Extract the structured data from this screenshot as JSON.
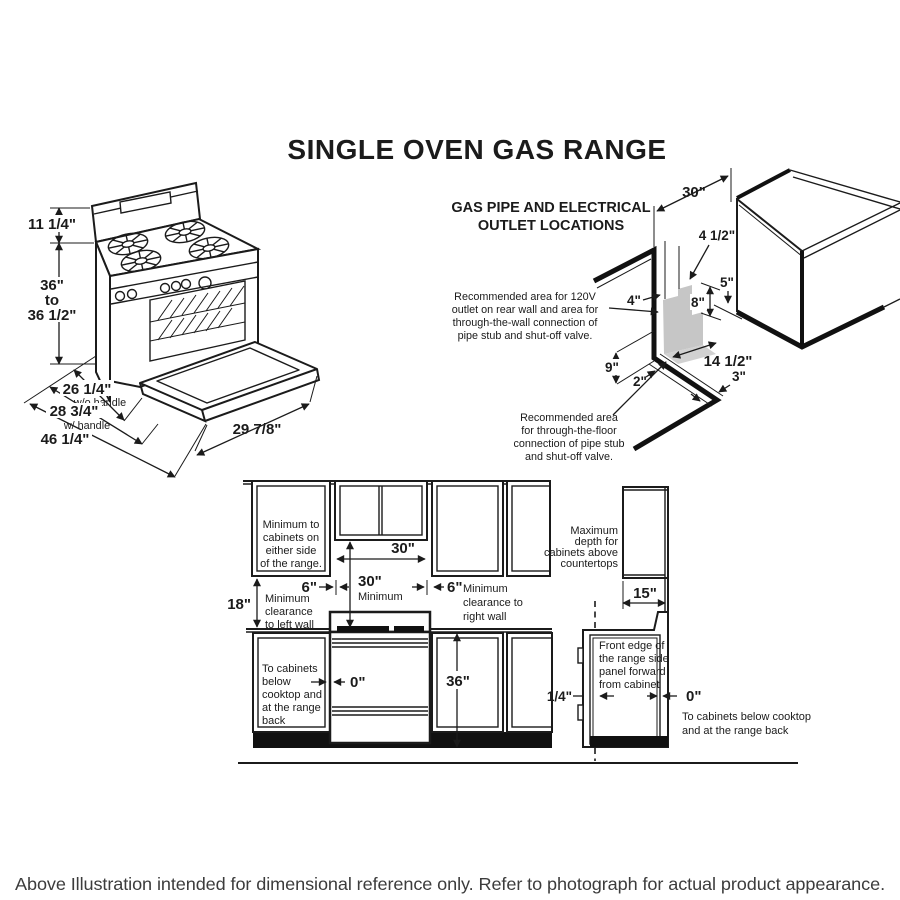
{
  "title": "SINGLE OVEN GAS RANGE",
  "footer": "Above Illustration intended for dimensional reference only. Refer to photograph for actual product appearance.",
  "accent_colors": {
    "line": "#1b1b1b",
    "shaded_area": "#c6c6c6"
  },
  "range_isometric": {
    "backsplash_height": "11 1/4\"",
    "height_min": "36\"",
    "height_to": "to",
    "height_max": "36 1/2\"",
    "depth_no_handle": "26 1/4\"",
    "depth_no_handle_label": "w/o handle",
    "depth_handle": "28 3/4\"",
    "depth_handle_label": "w/ handle",
    "depth_door_open": "46 1/4\"",
    "door_width": "29 7/8\""
  },
  "gas_outlet_diagram": {
    "title_line1": "GAS PIPE AND ELECTRICAL",
    "title_line2": "OUTLET LOCATIONS",
    "wall_note": [
      "Recommended area for 120V",
      "outlet on rear wall and area for",
      "through-the-wall connection of",
      "pipe stub and shut-off valve."
    ],
    "floor_note": [
      "Recommended area",
      "for through-the-floor",
      "connection of pipe stub",
      "and shut-off valve."
    ],
    "dims": {
      "width_30": "30\"",
      "offset_4_5": "4 1/2\"",
      "gap_5": "5\"",
      "height_8": "8\"",
      "width_4": "4\"",
      "height_9": "9\"",
      "offset_2": "2\"",
      "depth_14_5": "14 1/2\"",
      "offset_3": "3\""
    }
  },
  "front_elevation": {
    "cabinet_note": [
      "Minimum to",
      "cabinets on",
      "either side",
      "of the range."
    ],
    "width_30": "30\"",
    "vert_30": "30\"",
    "vert_30_label": "Minimum",
    "left_6": "6\"",
    "right_6": "6\"",
    "left_wall_note": [
      "Minimum",
      "clearance",
      "to left wall"
    ],
    "right_wall_note": [
      "Minimum",
      "clearance to",
      "right wall"
    ],
    "left_18": "18\"",
    "below_note": [
      "To cabinets",
      "below",
      "cooktop and",
      "at the range",
      "back"
    ],
    "zero": "0\"",
    "counter_36": "36\""
  },
  "side_view": {
    "depth_note": [
      "Maximum",
      "depth for",
      "cabinets above",
      "countertops"
    ],
    "depth_15": "15\"",
    "front_edge_note": [
      "Front edge of",
      "the range side",
      "panel forward",
      "from cabinet"
    ],
    "quarter": "1/4\"",
    "zero": "0\"",
    "zero_note": [
      "To cabinets below cooktop",
      "and at the range back"
    ]
  }
}
